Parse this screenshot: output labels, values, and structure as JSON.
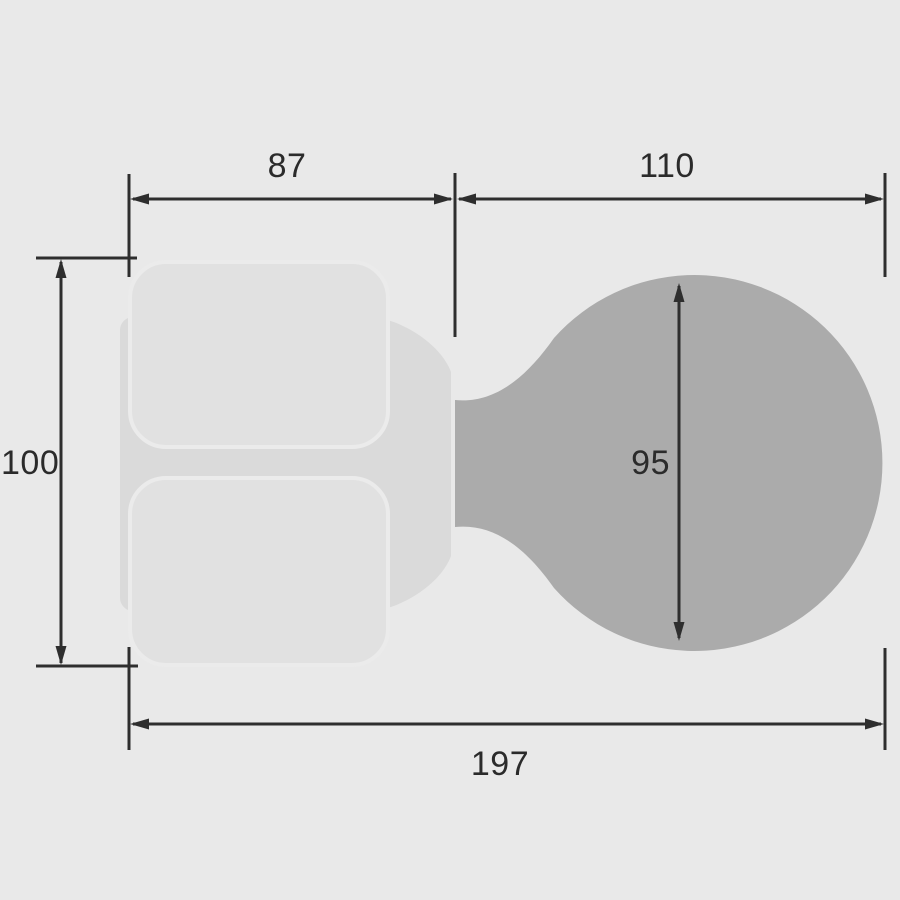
{
  "diagram": {
    "labels": {
      "left_section_width": "87",
      "right_section_width": "110",
      "plate_height": "100",
      "knob_diameter": "95",
      "overall_width": "197"
    },
    "colors": {
      "background": "#e9e9e9",
      "line": "#2e2e2e",
      "text": "#2b2b2b",
      "knob": "#ababab",
      "backplate": "#dadada",
      "rose_fill": "#e1e1e1",
      "rose_stroke": "#ebebeb"
    }
  }
}
